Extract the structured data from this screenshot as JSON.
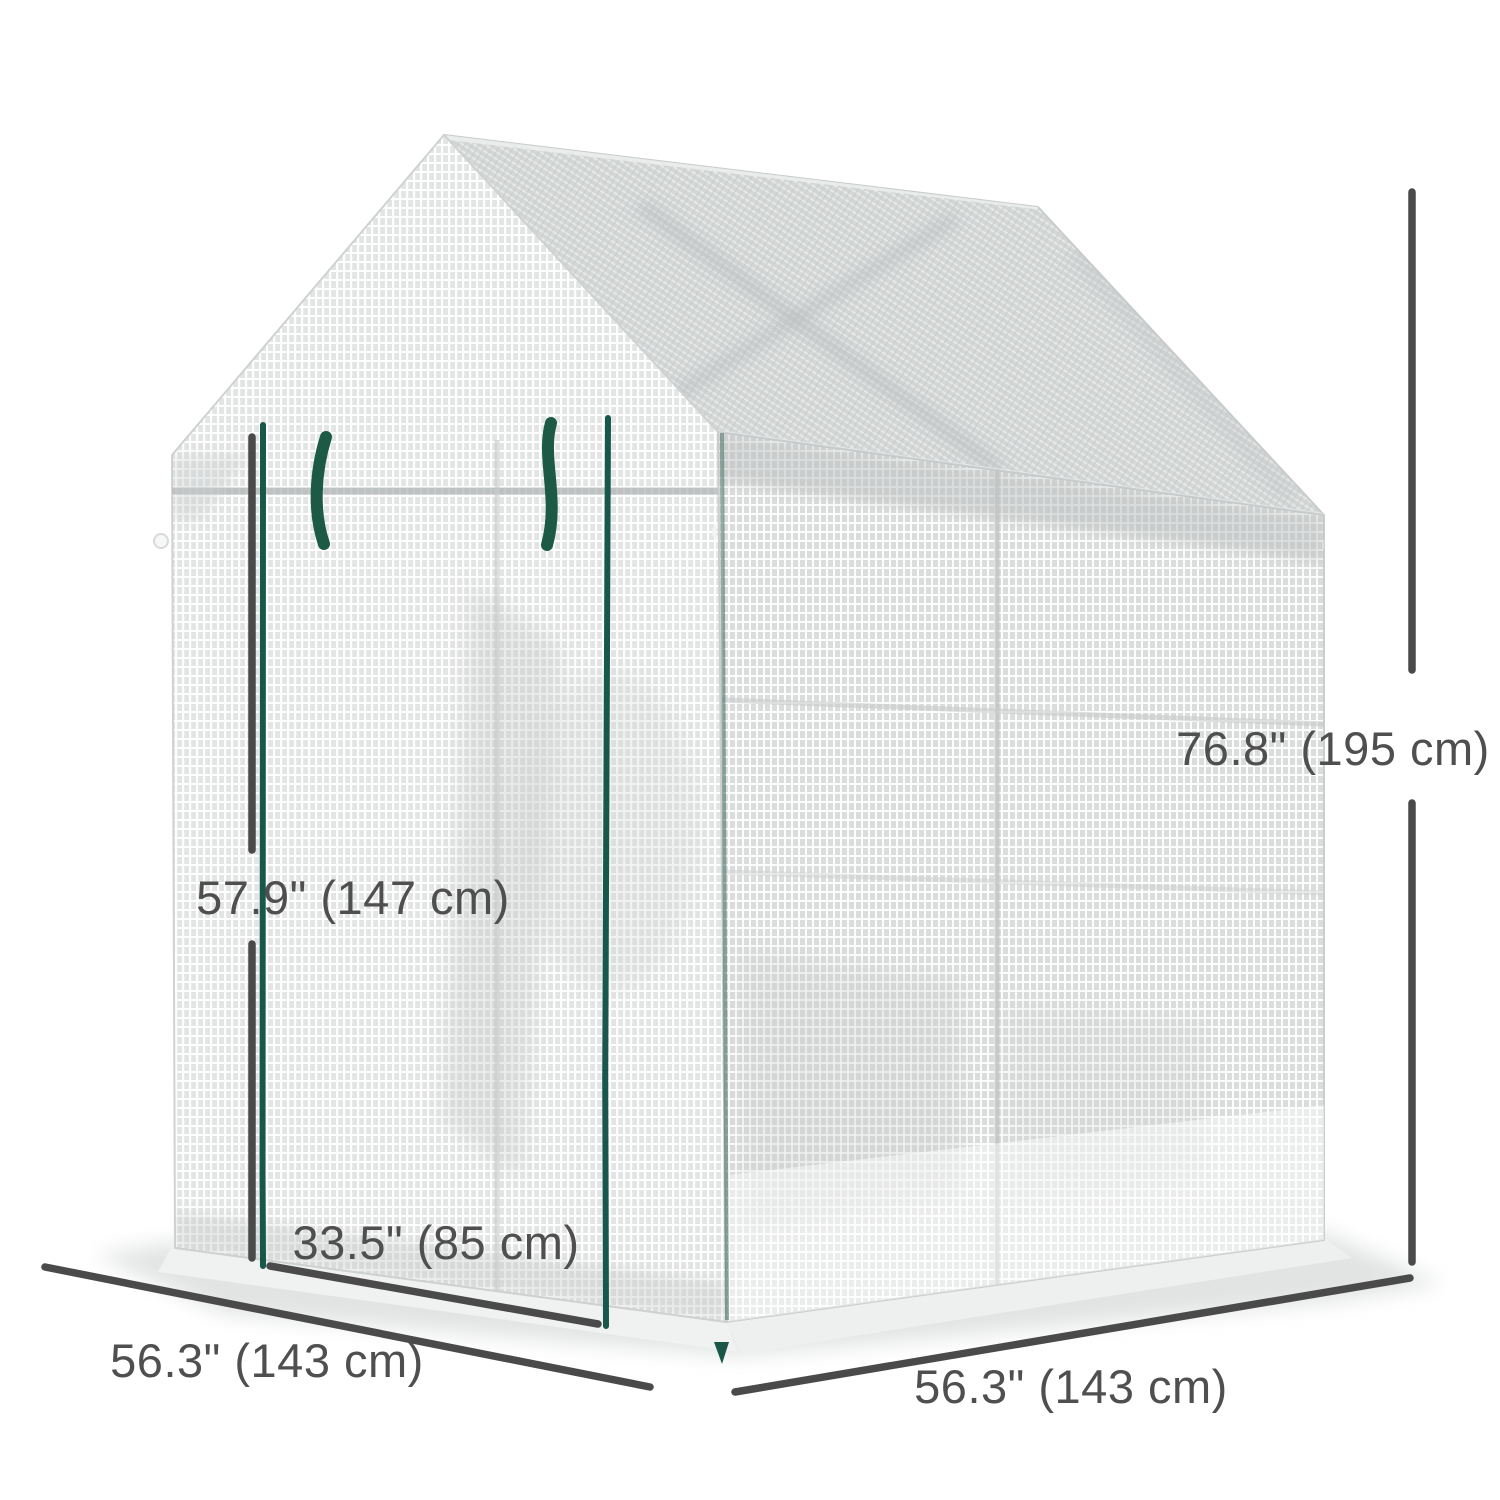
{
  "illustration": {
    "subject": "walk-in mesh greenhouse with roll-up zipper door",
    "cover_color": "#e3e4e4",
    "roof_color": "#d5d7d7",
    "zipper_green": "#17584a",
    "handle_green": "#1d5a46",
    "annotation_color": "#4a4a4a"
  },
  "dimensions": {
    "overall_height": "76.8\" (195 cm)",
    "door_height": "57.9\" (147 cm)",
    "door_width": "33.5\" (85 cm)",
    "base_width": "56.3\" (143 cm)",
    "base_depth": "56.3\" (143 cm)"
  }
}
